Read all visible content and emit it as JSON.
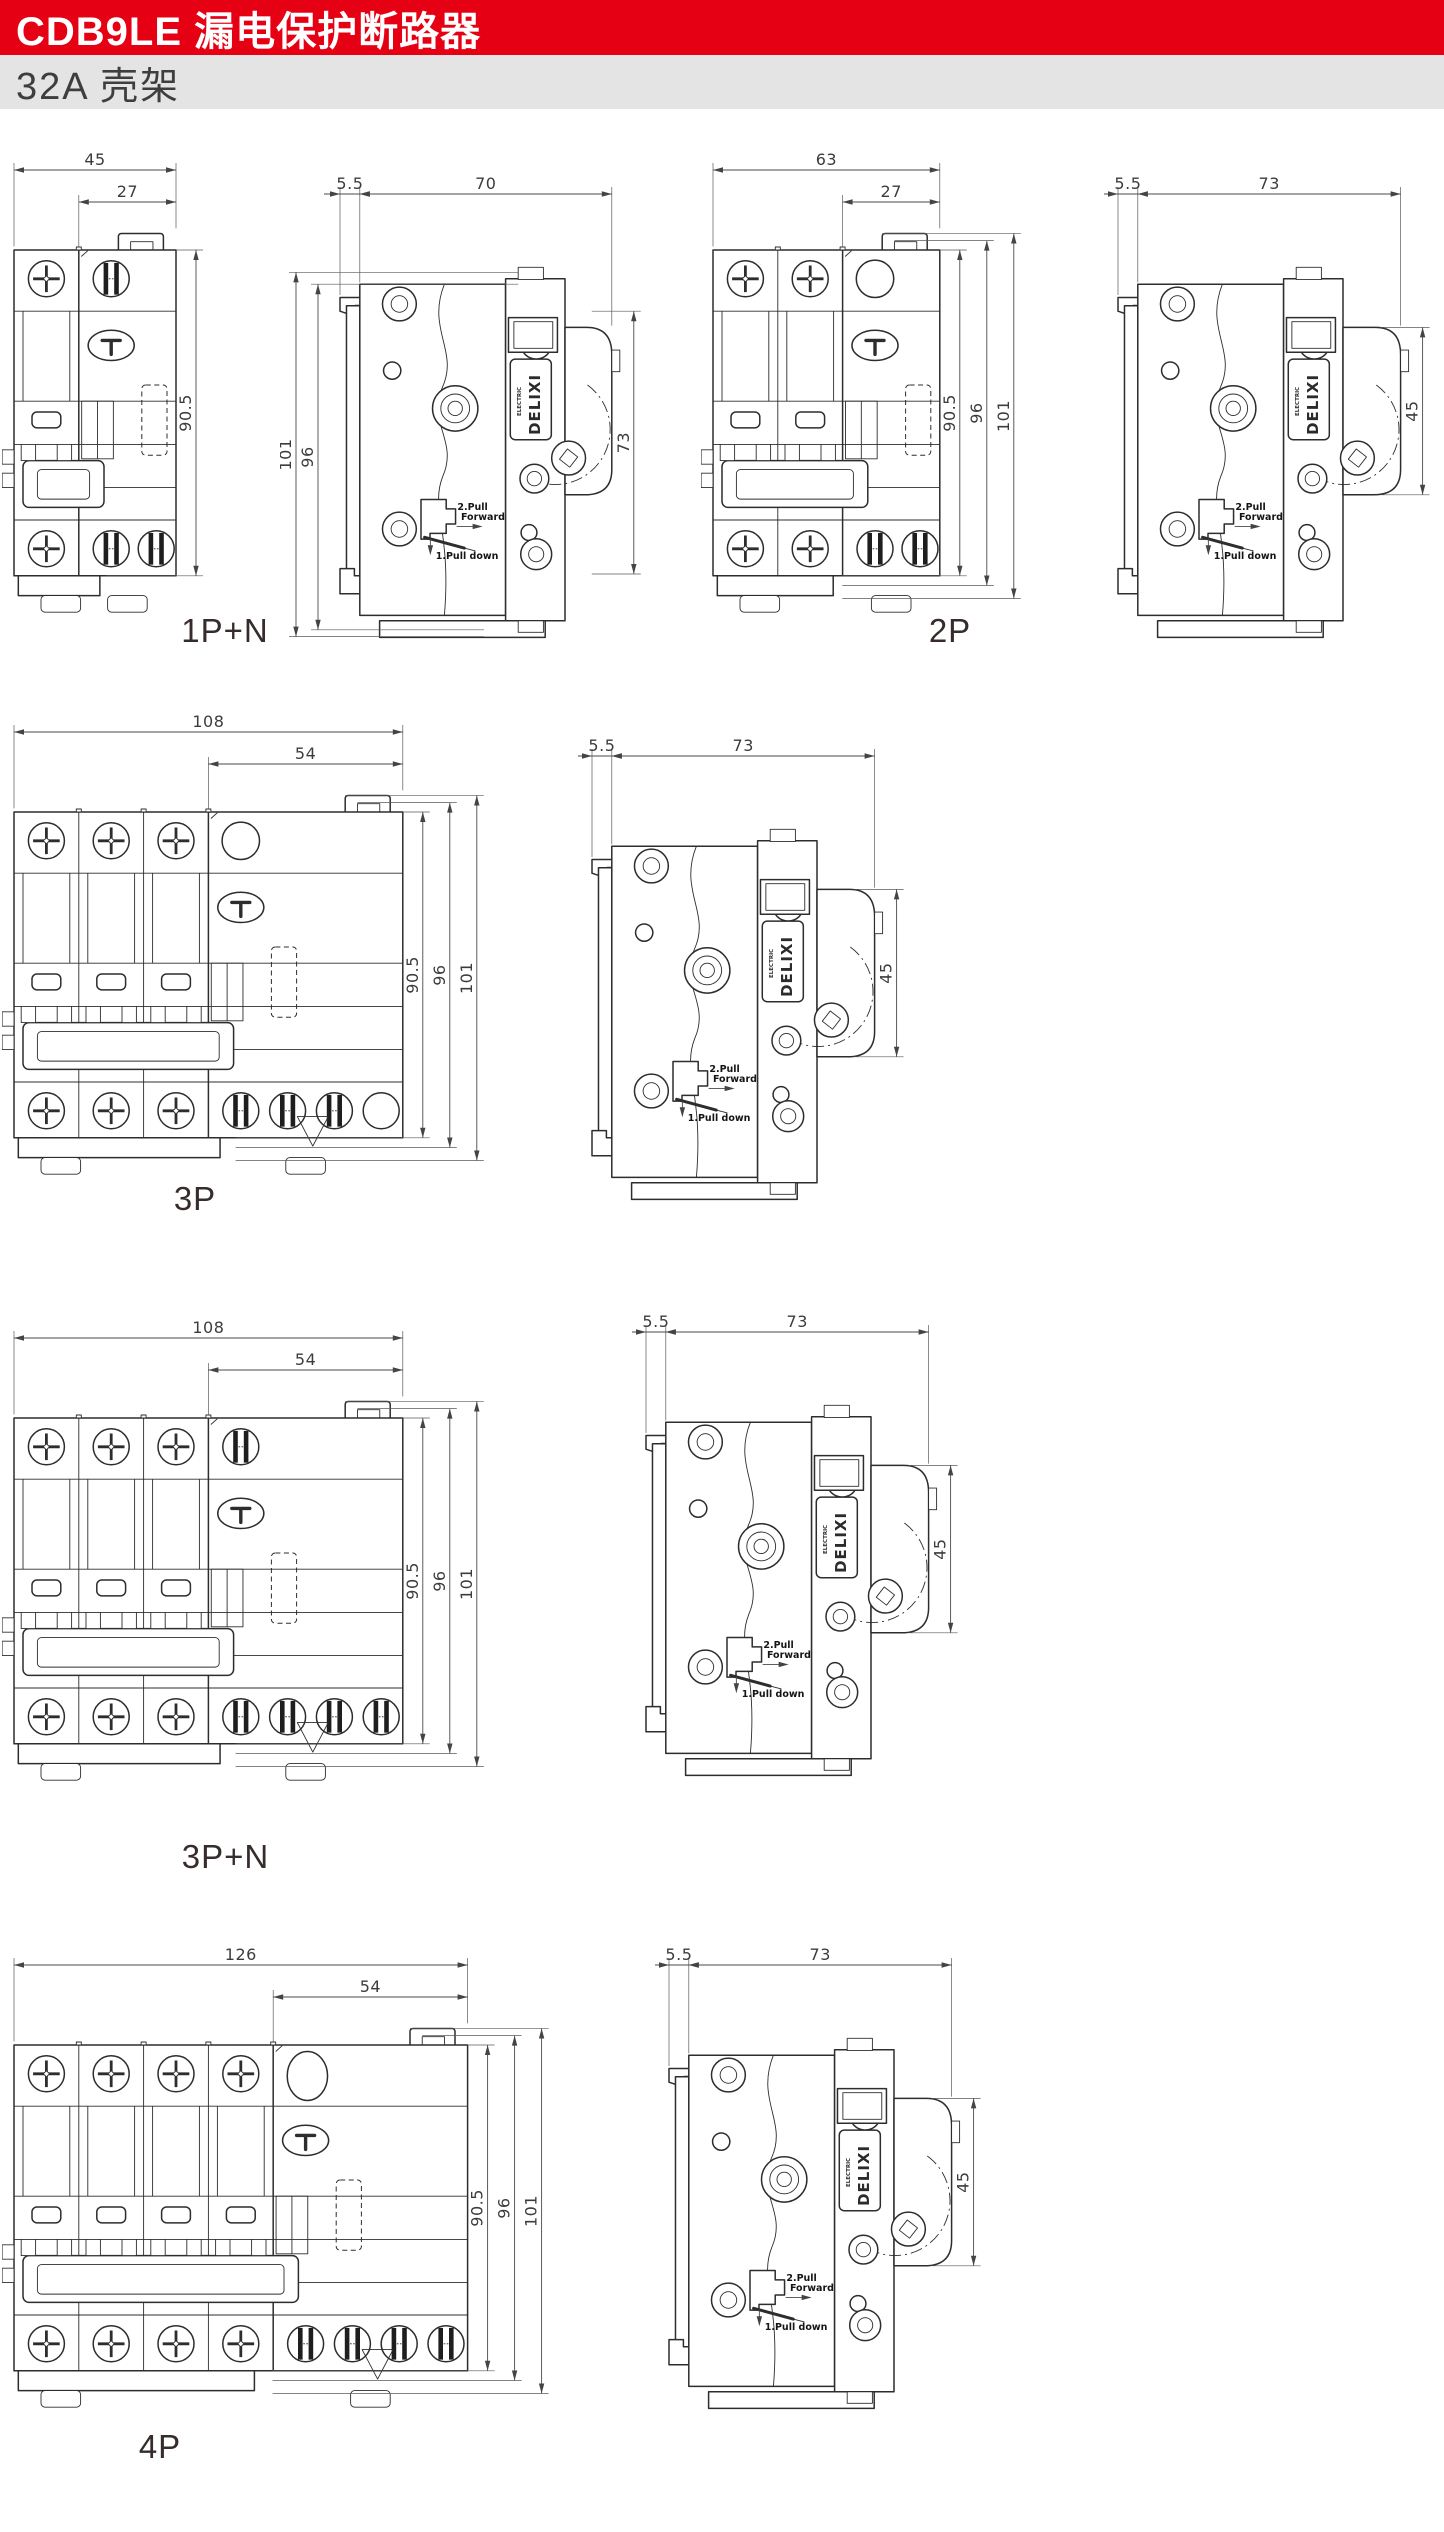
{
  "header": {
    "title": "CDB9LE 漏电保护断路器",
    "subtitle": "32A 壳架",
    "accent_color": "#e60013",
    "subtitle_bar_color": "#e4e4e4"
  },
  "annotations": {
    "brand": "DELIXI",
    "brand_sub": "ELECTRIC",
    "pull_step2_line1": "2.Pull",
    "pull_step2_line2": "Forward",
    "pull_step1": "1.Pull down"
  },
  "sections": [
    {
      "id": "1pn",
      "label": "1P+N",
      "front": {
        "overall_width": "45",
        "sub_width": "27",
        "poles": 1,
        "height_dims": [
          "90.5"
        ],
        "rcd_top_screw": "bars",
        "rcd_bottom_screws": 2,
        "rcd_bottom_extra_circle": false,
        "triangle": false
      },
      "side": {
        "rail_offset": "5.5",
        "depth": "70",
        "height_dim": "73",
        "left_height_dims": [
          "101",
          "96"
        ]
      }
    },
    {
      "id": "2p",
      "label": "2P",
      "front": {
        "overall_width": "63",
        "sub_width": "27",
        "poles": 2,
        "height_dims": [
          "90.5",
          "96",
          "101"
        ],
        "rcd_top_screw": "circle",
        "rcd_bottom_screws": 2,
        "rcd_bottom_extra_circle": false,
        "triangle": false
      },
      "side": {
        "rail_offset": "5.5",
        "depth": "73",
        "height_dim": "45",
        "left_height_dims": []
      }
    },
    {
      "id": "3p",
      "label": "3P",
      "front": {
        "overall_width": "108",
        "sub_width": "54",
        "poles": 3,
        "height_dims": [
          "90.5",
          "96",
          "101"
        ],
        "rcd_top_screw": "circle",
        "rcd_bottom_screws": 3,
        "rcd_bottom_extra_circle": true,
        "triangle": true
      },
      "side": {
        "rail_offset": "5.5",
        "depth": "73",
        "height_dim": "45",
        "left_height_dims": []
      }
    },
    {
      "id": "3pn",
      "label": "3P+N",
      "front": {
        "overall_width": "108",
        "sub_width": "54",
        "poles": 3,
        "height_dims": [
          "90.5",
          "96",
          "101"
        ],
        "rcd_top_screw": "bars",
        "rcd_bottom_screws": 4,
        "rcd_bottom_extra_circle": false,
        "triangle": true
      },
      "side": {
        "rail_offset": "5.5",
        "depth": "73",
        "height_dim": "45",
        "left_height_dims": []
      }
    },
    {
      "id": "4p",
      "label": "4P",
      "front": {
        "overall_width": "126",
        "sub_width": "54",
        "poles": 4,
        "height_dims": [
          "90.5",
          "96",
          "101"
        ],
        "rcd_top_screw": "big-circle",
        "rcd_bottom_screws": 4,
        "rcd_bottom_extra_circle": false,
        "triangle": true
      },
      "side": {
        "rail_offset": "5.5",
        "depth": "73",
        "height_dim": "45",
        "left_height_dims": []
      }
    }
  ]
}
